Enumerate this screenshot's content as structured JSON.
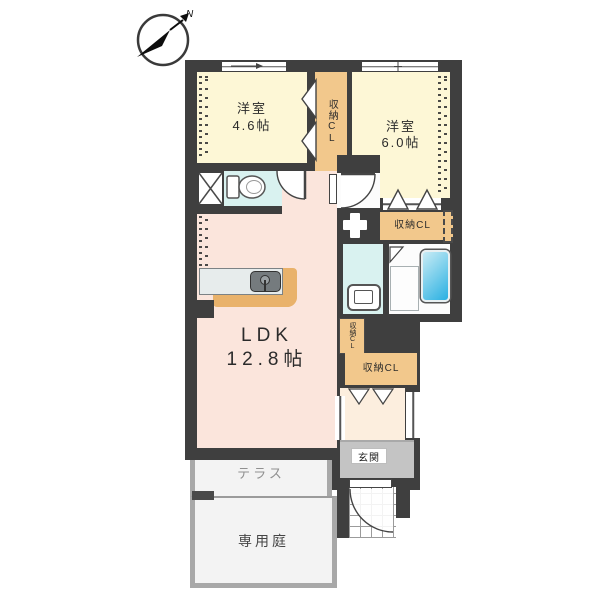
{
  "compass": {
    "north_label": "N"
  },
  "rooms": {
    "bedroom_small": {
      "name": "洋室",
      "size": "4.6帖"
    },
    "bedroom_large": {
      "name": "洋室",
      "size": "6.0帖"
    },
    "ldk": {
      "name": "LDK",
      "size": "12.8帖"
    },
    "closet_bedroom_small": {
      "label": "収納CL"
    },
    "closet_bedroom_large": {
      "label": "収納CL"
    },
    "closet_ldk": {
      "label": "収納CL"
    },
    "closet_hall": {
      "label": "収納CL"
    },
    "entrance": {
      "label": "玄関"
    },
    "terrace": {
      "label": "テラス"
    },
    "private_garden": {
      "label": "専用庭"
    }
  },
  "colors": {
    "wall": "#3f3f3f",
    "bedroom_fill": "#fdf7d6",
    "ldk_fill": "#fbe5dc",
    "wet_area_fill": "#d9f2f0",
    "closet_fill": "#f2c88c",
    "entrance_fill": "#c4c4c4",
    "bathtub_fill": "#2fb3e4",
    "kitchen_counter_fill": "#e9b26b",
    "terrace_fill": "#f3f3f3"
  }
}
